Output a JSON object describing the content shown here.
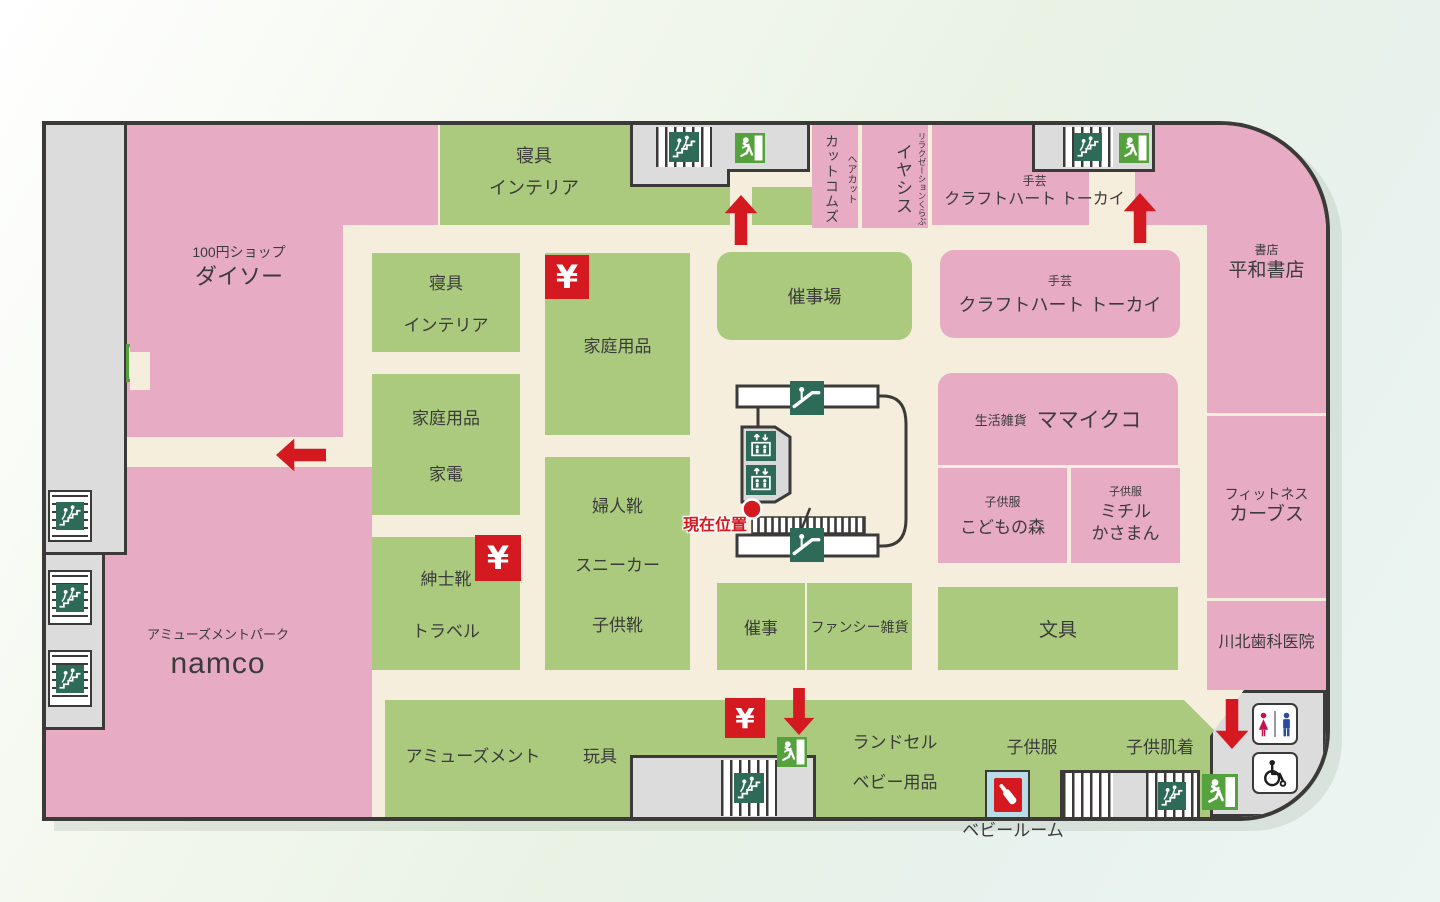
{
  "legend": {
    "current_location": "現在位置",
    "baby_room": "ベビールーム",
    "yen": "¥"
  },
  "colors": {
    "shop_pink": "#e7abc3",
    "shop_green": "#abca7e",
    "walkway_beige": "#f5eedd",
    "service_gray": "#dcdcdc",
    "outline": "#3c3a38",
    "facility_icon_green": "#2e6a58",
    "exit_green": "#55a13e",
    "accent_red": "#d41a20"
  },
  "icons": {
    "stairs": "stairs-icon",
    "escalator": "escalator-icon",
    "elevator": "elevator-icon",
    "exit": "emergency-exit-icon",
    "toilet": "toilet-icon",
    "wheelchair": "wheelchair-icon",
    "baby_room": "baby-bottle-icon",
    "atm": "yen-icon"
  },
  "stores": {
    "daiso": {
      "category": "100円ショップ",
      "name": "ダイソー"
    },
    "futon_interior_north": {
      "line1": "寝具",
      "line2": "インテリア"
    },
    "cutcoms": {
      "category": "ヘアカット",
      "name": "カットコムズ"
    },
    "iyashisu": {
      "category": "リラクゼーションくらぶ",
      "name": "イヤシス"
    },
    "craftheart_tokai_north": {
      "category": "手芸",
      "name": "クラフトハート トーカイ"
    },
    "heiwa_shoten": {
      "category": "書店",
      "name": "平和書店"
    },
    "saijijo": "催事場",
    "craftheart_tokai": {
      "category": "手芸",
      "name": "クラフトハート トーカイ"
    },
    "futon_interior": {
      "line1": "寝具",
      "line2": "インテリア"
    },
    "household_kaden": {
      "line1": "家庭用品",
      "line2": "家電"
    },
    "household": "家庭用品",
    "ladies_shoes": {
      "line1": "婦人靴",
      "line2": "スニーカー",
      "line3": "子供靴"
    },
    "mens_shoes": {
      "line1": "紳士靴",
      "line2": "トラベル"
    },
    "mamaikuko": {
      "category": "生活雑貨",
      "name": "ママイクコ"
    },
    "kodomono_mori": {
      "category": "子供服",
      "name": "こどもの森"
    },
    "michiru_kasaman": {
      "category": "子供服",
      "line1": "ミチル",
      "line2": "かさまん"
    },
    "curves": {
      "category": "フィットネス",
      "name": "カーブス"
    },
    "saiji": "催事",
    "fancy_zakka": "ファンシー雑貨",
    "bungu": "文具",
    "kawakita_dental": "川北歯科医院",
    "namco": {
      "category": "アミューズメントパーク",
      "name": "namco"
    },
    "amusement": "アミューズメント",
    "toys": "玩具",
    "randoseru_baby": {
      "line1": "ランドセル",
      "line2": "ベビー用品"
    },
    "kids_clothes": "子供服",
    "kids_underwear": "子供肌着"
  }
}
